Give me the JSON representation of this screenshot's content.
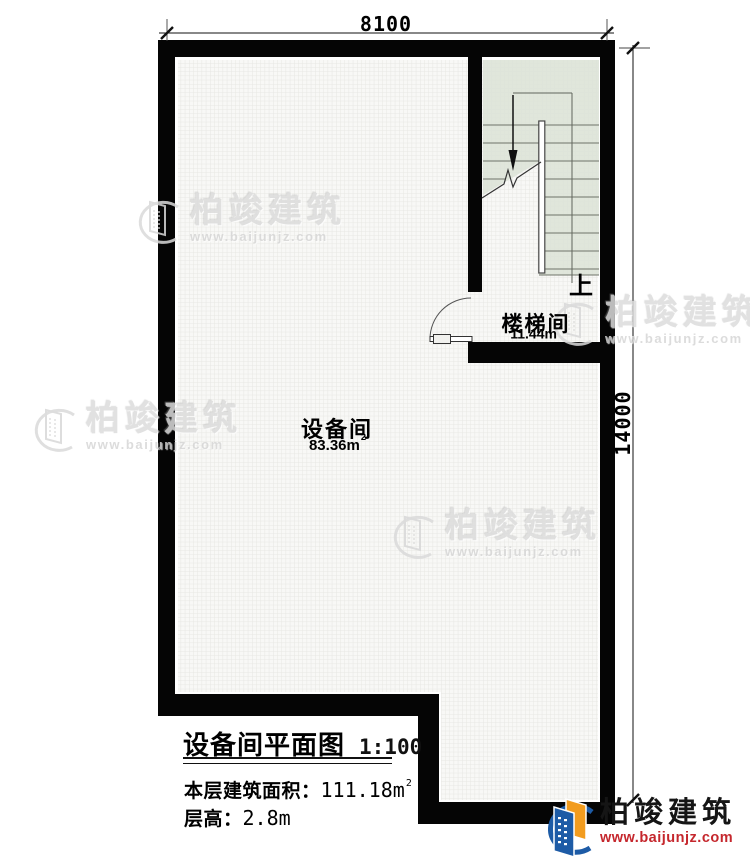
{
  "plan": {
    "dim_top": "8100",
    "dim_right": "14000",
    "up_label": "上"
  },
  "rooms": [
    {
      "name": "设备间",
      "area_base": "83.36m",
      "area_sup": "2"
    },
    {
      "name": "楼梯间",
      "area_base": "11.44m",
      "area_sup": "2"
    }
  ],
  "title_block": {
    "title": "设备间平面图",
    "scale": "1:100",
    "area_label": "本层建筑面积：",
    "area_value": "111.18m",
    "area_sup": "2",
    "floor_height_label": "层高：",
    "floor_height_value": "2.8m"
  },
  "branding": {
    "name": "柏竣建筑",
    "url": "www.baijunjz.com"
  },
  "watermark": {
    "name": "柏竣建筑",
    "url": "www.baijunjz.com"
  },
  "colors": {
    "wall": "#050505",
    "stair_area": "#dce2d7",
    "floor_grid_line": "#e7e7e3",
    "floor_base": "#f8f8f6",
    "logo_blue": "#1d5ba6",
    "logo_orange": "#f29c1f",
    "logo_url_red": "#c5272d"
  }
}
